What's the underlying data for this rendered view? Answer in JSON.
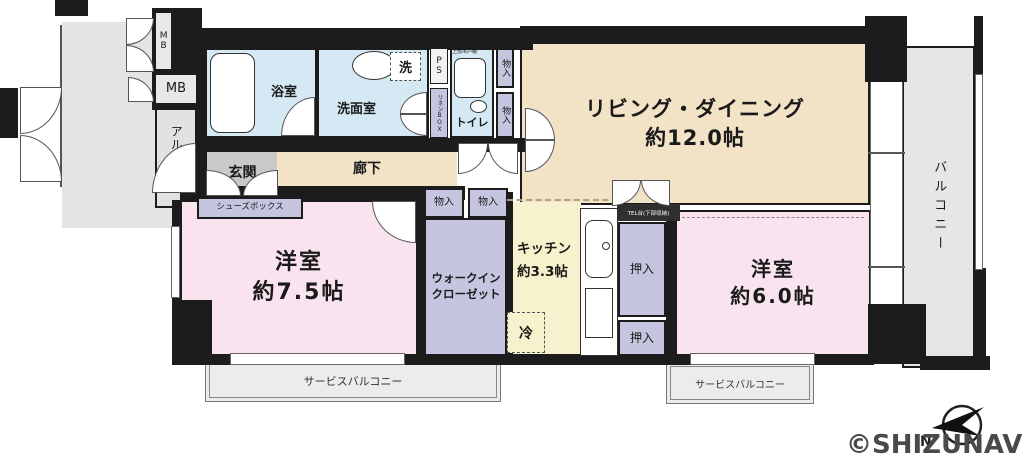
{
  "rooms": {
    "living": {
      "label": "リビング・ダイニング",
      "size": "約12.0帖"
    },
    "bedroom1": {
      "label": "洋室",
      "size": "約7.5帖"
    },
    "bedroom2": {
      "label": "洋室",
      "size": "約6.0帖"
    },
    "kitchen": {
      "label": "キッチン",
      "size": "約3.3帖"
    },
    "bath": {
      "label": "浴室"
    },
    "washroom": {
      "label": "洗面室"
    },
    "toilet": {
      "label": "トイレ"
    },
    "upper_cabinet": {
      "label": "上部吊戸棚"
    },
    "laundry": {
      "label": "洗"
    },
    "fridge": {
      "label": "冷"
    },
    "ps": {
      "label": "PS"
    },
    "linen_box": {
      "label": "リネンBOX"
    },
    "mb_top": {
      "label": "MB"
    },
    "mb": {
      "label": "MB"
    },
    "alcove": {
      "label": "アルコーブ"
    },
    "entrance": {
      "label": "玄関"
    },
    "shoes_box": {
      "label": "シューズボックス"
    },
    "corridor": {
      "label": "廊下"
    },
    "storage_hall_1": {
      "label": "物入"
    },
    "storage_hall_2": {
      "label": "物入"
    },
    "storage_wic_1": {
      "label": "物入"
    },
    "storage_wic_2": {
      "label": "物入"
    },
    "wic": {
      "line1": "ウォークイン",
      "line2": "クローゼット"
    },
    "tel_stand": {
      "label": "TEL台(下部収納)"
    },
    "oshiire_1": {
      "label": "押入"
    },
    "oshiire_2": {
      "label": "押入"
    },
    "balcony": {
      "label": "バルコニー"
    },
    "service_balcony_left": {
      "label": "サービスバルコニー"
    },
    "service_balcony_right": {
      "label": "サービスバルコニー"
    }
  },
  "compass": {
    "north_label": "N"
  },
  "watermark": "©SHIZUNAVI",
  "colors": {
    "wall": "#1c1c1c",
    "living_beige": "#f2e2c6",
    "room_pink": "#f8e3ee",
    "water_blue": "#d4e9f3",
    "kitchen_yellow": "#f7f2cd",
    "closet_purple": "#c6c5df",
    "balcony_gray": "#e6e6e6",
    "entrance_gray": "#c9c9c9",
    "common_gray": "#e4e4e4"
  }
}
